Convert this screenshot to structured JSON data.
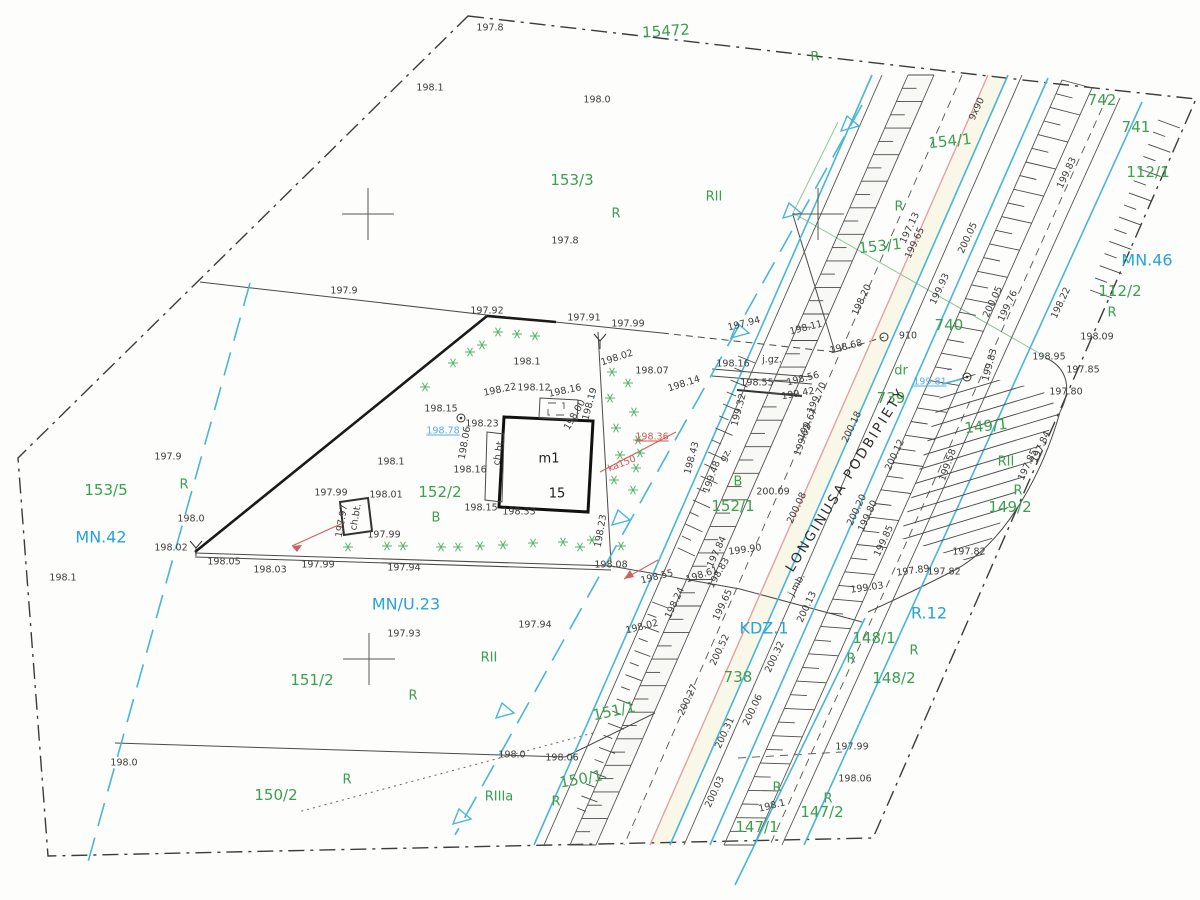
{
  "map": {
    "street_name": "LONGINUSA PODBIPIETY",
    "building": {
      "label": "m1",
      "number": "15"
    },
    "colors": {
      "parcel_green": "#3aa04f",
      "zone_blue": "#27a3d8",
      "utility_blue": "#58aee6",
      "utility_red": "#d05555",
      "road_cyan": "#49b6d6",
      "line_black": "#3d3d3d"
    },
    "labels": [
      {
        "t": "15472",
        "x": 666,
        "y": 31,
        "c": "p",
        "r": -4
      },
      {
        "t": "R",
        "x": 815,
        "y": 57,
        "c": "l",
        "r": -4
      },
      {
        "t": "153/3",
        "x": 572,
        "y": 180,
        "c": "p"
      },
      {
        "t": "RII",
        "x": 714,
        "y": 197,
        "c": "l"
      },
      {
        "t": "R",
        "x": 616,
        "y": 214,
        "c": "l"
      },
      {
        "t": "154/1",
        "x": 950,
        "y": 141,
        "c": "p",
        "r": -6
      },
      {
        "t": "153/1",
        "x": 880,
        "y": 246,
        "c": "p",
        "r": -6
      },
      {
        "t": "R",
        "x": 899,
        "y": 207,
        "c": "l"
      },
      {
        "t": "742",
        "x": 1102,
        "y": 100,
        "c": "p"
      },
      {
        "t": "741",
        "x": 1136,
        "y": 127,
        "c": "p"
      },
      {
        "t": "112/1",
        "x": 1148,
        "y": 172,
        "c": "p"
      },
      {
        "t": "MN.46",
        "x": 1147,
        "y": 260,
        "c": "z"
      },
      {
        "t": "112/2",
        "x": 1120,
        "y": 291,
        "c": "p"
      },
      {
        "t": "R",
        "x": 1112,
        "y": 313,
        "c": "l"
      },
      {
        "t": "740",
        "x": 949,
        "y": 325,
        "c": "p"
      },
      {
        "t": "dr",
        "x": 901,
        "y": 371,
        "c": "l"
      },
      {
        "t": "739",
        "x": 891,
        "y": 398,
        "c": "p"
      },
      {
        "t": "153/5",
        "x": 106,
        "y": 490,
        "c": "p"
      },
      {
        "t": "R",
        "x": 184,
        "y": 485,
        "c": "l"
      },
      {
        "t": "MN.42",
        "x": 101,
        "y": 537,
        "c": "z"
      },
      {
        "t": "152/2",
        "x": 440,
        "y": 492,
        "c": "p"
      },
      {
        "t": "B",
        "x": 436,
        "y": 518,
        "c": "l"
      },
      {
        "t": "152/1",
        "x": 733,
        "y": 506,
        "c": "p"
      },
      {
        "t": "B",
        "x": 738,
        "y": 482,
        "c": "l"
      },
      {
        "t": "149/1",
        "x": 986,
        "y": 426,
        "c": "p",
        "r": -6
      },
      {
        "t": "RII",
        "x": 1006,
        "y": 462,
        "c": "l"
      },
      {
        "t": "R",
        "x": 1018,
        "y": 491,
        "c": "l"
      },
      {
        "t": "149/2",
        "x": 1010,
        "y": 507,
        "c": "p"
      },
      {
        "t": "MN/U.23",
        "x": 406,
        "y": 604,
        "c": "z"
      },
      {
        "t": "151/2",
        "x": 312,
        "y": 680,
        "c": "p"
      },
      {
        "t": "RII",
        "x": 489,
        "y": 658,
        "c": "l"
      },
      {
        "t": "R",
        "x": 413,
        "y": 696,
        "c": "l"
      },
      {
        "t": "KDZ.1",
        "x": 764,
        "y": 628,
        "c": "z"
      },
      {
        "t": "738",
        "x": 738,
        "y": 677,
        "c": "p"
      },
      {
        "t": "151/1",
        "x": 614,
        "y": 711,
        "c": "p",
        "r": -12
      },
      {
        "t": "R.12",
        "x": 929,
        "y": 613,
        "c": "z"
      },
      {
        "t": "148/1",
        "x": 874,
        "y": 638,
        "c": "p"
      },
      {
        "t": "R",
        "x": 851,
        "y": 659,
        "c": "l"
      },
      {
        "t": "R",
        "x": 914,
        "y": 651,
        "c": "l"
      },
      {
        "t": "148/2",
        "x": 894,
        "y": 678,
        "c": "p"
      },
      {
        "t": "150/2",
        "x": 276,
        "y": 795,
        "c": "p"
      },
      {
        "t": "R",
        "x": 347,
        "y": 780,
        "c": "l"
      },
      {
        "t": "RIIIa",
        "x": 499,
        "y": 797,
        "c": "l"
      },
      {
        "t": "R",
        "x": 556,
        "y": 802,
        "c": "l"
      },
      {
        "t": "150/1",
        "x": 581,
        "y": 779,
        "c": "p",
        "r": -10
      },
      {
        "t": "147/2",
        "x": 822,
        "y": 812,
        "c": "p"
      },
      {
        "t": "R",
        "x": 828,
        "y": 799,
        "c": "l"
      },
      {
        "t": "R",
        "x": 777,
        "y": 788,
        "c": "l"
      },
      {
        "t": "147/1",
        "x": 757,
        "y": 827,
        "c": "p"
      },
      {
        "t": "LONGINUSA PODBIPIETY",
        "x": 846,
        "y": 480,
        "c": "st",
        "r": -58
      },
      {
        "t": "m1",
        "x": 549,
        "y": 459,
        "c": "bl"
      },
      {
        "t": "15",
        "x": 557,
        "y": 494,
        "c": "bl"
      },
      {
        "t": "197.8",
        "x": 490,
        "y": 28,
        "c": "e"
      },
      {
        "t": "198.1",
        "x": 430,
        "y": 88,
        "c": "e"
      },
      {
        "t": "198.0",
        "x": 597,
        "y": 100,
        "c": "e"
      },
      {
        "t": "197.8",
        "x": 565,
        "y": 241,
        "c": "e"
      },
      {
        "t": "197.9",
        "x": 344,
        "y": 291,
        "c": "e"
      },
      {
        "t": "197.92",
        "x": 487,
        "y": 311,
        "c": "e"
      },
      {
        "t": "197.91",
        "x": 584,
        "y": 318,
        "c": "e"
      },
      {
        "t": "197.99",
        "x": 628,
        "y": 324,
        "c": "e"
      },
      {
        "t": "198.1",
        "x": 527,
        "y": 362,
        "c": "e"
      },
      {
        "t": "198.02",
        "x": 617,
        "y": 358,
        "c": "e",
        "r": -18
      },
      {
        "t": "198.07",
        "x": 652,
        "y": 371,
        "c": "e"
      },
      {
        "t": "198.14",
        "x": 684,
        "y": 384,
        "c": "e",
        "r": -18
      },
      {
        "t": "198.15",
        "x": 441,
        "y": 409,
        "c": "e"
      },
      {
        "t": "198.22",
        "x": 500,
        "y": 390,
        "c": "e",
        "r": -12
      },
      {
        "t": "198.12",
        "x": 534,
        "y": 388,
        "c": "e"
      },
      {
        "t": "198.16",
        "x": 565,
        "y": 391,
        "c": "e",
        "r": -12
      },
      {
        "t": "198.19",
        "x": 590,
        "y": 404,
        "c": "e",
        "r": -75
      },
      {
        "t": "198.00",
        "x": 575,
        "y": 415,
        "c": "e",
        "r": -60
      },
      {
        "t": "197.94",
        "x": 744,
        "y": 324,
        "c": "e",
        "r": -14
      },
      {
        "t": "198.11",
        "x": 806,
        "y": 328,
        "c": "e",
        "r": -14
      },
      {
        "t": "198.16",
        "x": 733,
        "y": 364,
        "c": "e"
      },
      {
        "t": "j.gz.",
        "x": 772,
        "y": 360,
        "c": "e"
      },
      {
        "t": "198.55",
        "x": 757,
        "y": 383,
        "c": "e"
      },
      {
        "t": "198.56",
        "x": 803,
        "y": 379,
        "c": "e",
        "r": -14
      },
      {
        "t": "199.42",
        "x": 798,
        "y": 394,
        "c": "e",
        "r": -10
      },
      {
        "t": "199.70",
        "x": 817,
        "y": 398,
        "c": "e",
        "r": -65
      },
      {
        "t": "199.67",
        "x": 808,
        "y": 424,
        "c": "e",
        "r": -65
      },
      {
        "t": "199.62",
        "x": 803,
        "y": 440,
        "c": "e",
        "r": -70
      },
      {
        "t": "199.32",
        "x": 739,
        "y": 410,
        "c": "e",
        "r": -75
      },
      {
        "t": "gz.",
        "x": 726,
        "y": 455,
        "c": "e",
        "r": -60
      },
      {
        "t": "199.48",
        "x": 712,
        "y": 477,
        "c": "e",
        "r": -70
      },
      {
        "t": "198.43",
        "x": 692,
        "y": 458,
        "c": "e",
        "r": -75
      },
      {
        "t": "200.09",
        "x": 773,
        "y": 492,
        "c": "e"
      },
      {
        "t": "198.23",
        "x": 482,
        "y": 424,
        "c": "e"
      },
      {
        "t": "198.06",
        "x": 465,
        "y": 443,
        "c": "e",
        "r": -80
      },
      {
        "t": "ch.bt.",
        "x": 499,
        "y": 452,
        "c": "e",
        "r": -80
      },
      {
        "t": "198.16",
        "x": 470,
        "y": 470,
        "c": "e"
      },
      {
        "t": "198.15",
        "x": 481,
        "y": 508,
        "c": "e"
      },
      {
        "t": "198.33",
        "x": 519,
        "y": 512,
        "c": "e"
      },
      {
        "t": "198.23",
        "x": 601,
        "y": 531,
        "c": "e",
        "r": -80
      },
      {
        "t": "198.1",
        "x": 391,
        "y": 462,
        "c": "e"
      },
      {
        "t": "198.01",
        "x": 386,
        "y": 495,
        "c": "e"
      },
      {
        "t": "197.99",
        "x": 331,
        "y": 493,
        "c": "e"
      },
      {
        "t": "197.99",
        "x": 384,
        "y": 535,
        "c": "e"
      },
      {
        "t": "ch.bt.",
        "x": 356,
        "y": 517,
        "c": "e",
        "r": -80
      },
      {
        "t": "197.97",
        "x": 342,
        "y": 521,
        "c": "e",
        "r": -80
      },
      {
        "t": "198.02",
        "x": 171,
        "y": 548,
        "c": "e"
      },
      {
        "t": "198.05",
        "x": 224,
        "y": 562,
        "c": "e"
      },
      {
        "t": "198.03",
        "x": 270,
        "y": 570,
        "c": "e"
      },
      {
        "t": "197.99",
        "x": 318,
        "y": 565,
        "c": "e"
      },
      {
        "t": "197.94",
        "x": 404,
        "y": 568,
        "c": "e"
      },
      {
        "t": "198.1",
        "x": 63,
        "y": 578,
        "c": "e"
      },
      {
        "t": "198.0",
        "x": 191,
        "y": 519,
        "c": "e"
      },
      {
        "t": "197.9",
        "x": 168,
        "y": 457,
        "c": "e"
      },
      {
        "t": "198.08",
        "x": 611,
        "y": 565,
        "c": "e"
      },
      {
        "t": "197.94",
        "x": 535,
        "y": 625,
        "c": "e"
      },
      {
        "t": "197.93",
        "x": 404,
        "y": 634,
        "c": "e"
      },
      {
        "t": "198.02",
        "x": 642,
        "y": 627,
        "c": "e",
        "r": -14
      },
      {
        "t": "198.24",
        "x": 675,
        "y": 603,
        "c": "e",
        "r": -65
      },
      {
        "t": "199.65",
        "x": 723,
        "y": 605,
        "c": "e",
        "r": -65
      },
      {
        "t": "200.13",
        "x": 807,
        "y": 607,
        "c": "e",
        "r": -65
      },
      {
        "t": "197.84",
        "x": 717,
        "y": 552,
        "c": "e",
        "r": -65
      },
      {
        "t": "199.90",
        "x": 745,
        "y": 550,
        "c": "e",
        "r": -8
      },
      {
        "t": "198.61",
        "x": 702,
        "y": 575,
        "c": "e",
        "r": -18
      },
      {
        "t": "198.55",
        "x": 657,
        "y": 577,
        "c": "e",
        "r": -14
      },
      {
        "t": "198.83",
        "x": 719,
        "y": 573,
        "c": "e",
        "r": -60
      },
      {
        "t": "j.mb.",
        "x": 797,
        "y": 585,
        "c": "e",
        "r": -60
      },
      {
        "t": "199.03",
        "x": 867,
        "y": 588,
        "c": "e",
        "r": -8
      },
      {
        "t": "200.32",
        "x": 775,
        "y": 657,
        "c": "e",
        "r": -65
      },
      {
        "t": "200.52",
        "x": 720,
        "y": 650,
        "c": "e",
        "r": -65
      },
      {
        "t": "200.27",
        "x": 688,
        "y": 700,
        "c": "e",
        "r": -65
      },
      {
        "t": "200.06",
        "x": 753,
        "y": 710,
        "c": "e",
        "r": -65
      },
      {
        "t": "200.31",
        "x": 725,
        "y": 733,
        "c": "e",
        "r": -65
      },
      {
        "t": "200.03",
        "x": 715,
        "y": 792,
        "c": "e",
        "r": -65
      },
      {
        "t": "197.99",
        "x": 852,
        "y": 747,
        "c": "e"
      },
      {
        "t": "198.06",
        "x": 855,
        "y": 779,
        "c": "e"
      },
      {
        "t": "198.1",
        "x": 772,
        "y": 806,
        "c": "e",
        "r": -14
      },
      {
        "t": "198.06",
        "x": 562,
        "y": 758,
        "c": "e"
      },
      {
        "t": "198.0",
        "x": 512,
        "y": 755,
        "c": "e"
      },
      {
        "t": "198.0",
        "x": 124,
        "y": 763,
        "c": "e"
      },
      {
        "t": "9x90",
        "x": 977,
        "y": 109,
        "c": "e",
        "r": -65
      },
      {
        "t": "199.83",
        "x": 1067,
        "y": 173,
        "c": "e",
        "r": -65
      },
      {
        "t": "197.13",
        "x": 910,
        "y": 228,
        "c": "e",
        "r": -65
      },
      {
        "t": "199.65",
        "x": 915,
        "y": 243,
        "c": "e",
        "r": -65
      },
      {
        "t": "198.20",
        "x": 862,
        "y": 300,
        "c": "e",
        "r": -65
      },
      {
        "t": "199.93",
        "x": 940,
        "y": 289,
        "c": "e",
        "r": -65
      },
      {
        "t": "200.05",
        "x": 968,
        "y": 238,
        "c": "e",
        "r": -65
      },
      {
        "t": "200.05",
        "x": 993,
        "y": 302,
        "c": "e",
        "r": -65
      },
      {
        "t": "199.76",
        "x": 1008,
        "y": 306,
        "c": "e",
        "r": -65
      },
      {
        "t": "198.22",
        "x": 1061,
        "y": 303,
        "c": "e",
        "r": -65
      },
      {
        "t": "198.09",
        "x": 1097,
        "y": 337,
        "c": "e"
      },
      {
        "t": "198.95",
        "x": 1049,
        "y": 357,
        "c": "e"
      },
      {
        "t": "197.85",
        "x": 1083,
        "y": 370,
        "c": "e"
      },
      {
        "t": "197.80",
        "x": 1066,
        "y": 392,
        "c": "e"
      },
      {
        "t": "197.84",
        "x": 1041,
        "y": 447,
        "c": "e",
        "r": -65
      },
      {
        "t": "197.85",
        "x": 1028,
        "y": 465,
        "c": "e",
        "r": -65
      },
      {
        "t": "199.83",
        "x": 990,
        "y": 365,
        "c": "e",
        "r": -75
      },
      {
        "t": "199.58",
        "x": 948,
        "y": 465,
        "c": "e",
        "r": -70
      },
      {
        "t": "197.82",
        "x": 969,
        "y": 552,
        "c": "e"
      },
      {
        "t": "197.82",
        "x": 944,
        "y": 572,
        "c": "e"
      },
      {
        "t": "197.89",
        "x": 913,
        "y": 571,
        "c": "e",
        "r": -8
      },
      {
        "t": "910",
        "x": 908,
        "y": 336,
        "c": "e"
      },
      {
        "t": "198.68",
        "x": 846,
        "y": 347,
        "c": "e",
        "r": -14
      },
      {
        "t": "200.18",
        "x": 852,
        "y": 427,
        "c": "e",
        "r": -65
      },
      {
        "t": "200.12",
        "x": 895,
        "y": 455,
        "c": "e",
        "r": -65
      },
      {
        "t": "200.20",
        "x": 857,
        "y": 510,
        "c": "e",
        "r": -65
      },
      {
        "t": "199.80",
        "x": 868,
        "y": 516,
        "c": "e",
        "r": -65
      },
      {
        "t": "199.85",
        "x": 884,
        "y": 541,
        "c": "e",
        "r": -65
      },
      {
        "t": "200.08",
        "x": 797,
        "y": 508,
        "c": "e",
        "r": -65
      },
      {
        "t": "199.81",
        "x": 930,
        "y": 382,
        "c": "bu"
      },
      {
        "t": "198.78",
        "x": 443,
        "y": 431,
        "c": "bu"
      },
      {
        "t": "198.36",
        "x": 652,
        "y": 437,
        "c": "ru"
      },
      {
        "t": "ka150",
        "x": 622,
        "y": 464,
        "c": "rd",
        "r": -22
      }
    ],
    "symbols": {
      "trees": [
        [
          498,
          332
        ],
        [
          517,
          334
        ],
        [
          535,
          336
        ],
        [
          470,
          352
        ],
        [
          482,
          345
        ],
        [
          453,
          363
        ],
        [
          425,
          387
        ],
        [
          348,
          547
        ],
        [
          387,
          546
        ],
        [
          403,
          546
        ],
        [
          441,
          547
        ],
        [
          458,
          547
        ],
        [
          480,
          546
        ],
        [
          503,
          545
        ],
        [
          533,
          543
        ],
        [
          563,
          542
        ],
        [
          592,
          540
        ],
        [
          621,
          546
        ],
        [
          580,
          547
        ],
        [
          640,
          453
        ],
        [
          633,
          490
        ],
        [
          612,
          372
        ],
        [
          628,
          383
        ],
        [
          610,
          398
        ],
        [
          634,
          412
        ],
        [
          616,
          428
        ],
        [
          638,
          440
        ],
        [
          620,
          455
        ],
        [
          636,
          468
        ],
        [
          614,
          480
        ]
      ],
      "flow_triangles": [
        [
          850,
          125
        ],
        [
          792,
          212
        ],
        [
          740,
          332
        ],
        [
          621,
          519
        ],
        [
          505,
          712
        ],
        [
          462,
          818
        ]
      ],
      "grid_crosses": [
        [
          368,
          214
        ],
        [
          818,
          214
        ],
        [
          369,
          659
        ]
      ],
      "circles": [
        [
          461,
          418
        ],
        [
          884,
          337
        ],
        [
          967,
          377
        ]
      ],
      "y_symbols": [
        [
          600,
          341
        ],
        [
          196,
          548
        ]
      ]
    }
  }
}
